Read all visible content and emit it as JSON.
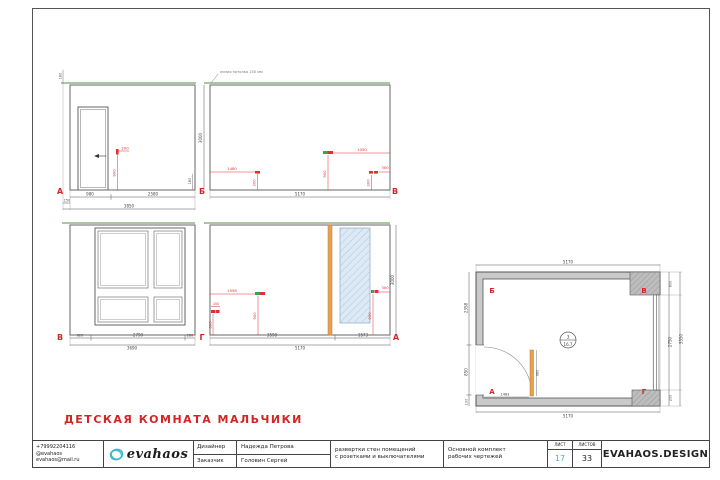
{
  "title": "ДЕТСКАЯ КОМНАТА МАЛЬЧИКИ",
  "colors": {
    "accent_red": "#d42525",
    "annotation_red": "#e03030",
    "brand_teal": "#3fb9c9",
    "ceiling_green": "#a9c7a2",
    "socket_green": "#2fa84f",
    "radiator_orange": "#e8a04d",
    "wall_gray": "#c9c9c9",
    "hatch_blue": "#ddeaf5"
  },
  "views": {
    "ab": {
      "corner_left": "А",
      "corner_right": "Б",
      "dim_ceiling": "180",
      "dim_skirt": "180",
      "switch_offset": "200",
      "switch_height": "900",
      "dim_door": "980",
      "dim_rest": "2580",
      "dim_offset": "150",
      "dim_total": "3850"
    },
    "bv": {
      "corner_right": "В",
      "note": "линия потолка 150 мм",
      "height": "3000",
      "s1_off": "1480",
      "s1_h": "300",
      "s2_off": "1050",
      "s2_h": "900",
      "s3_off": "300",
      "s3_h": "300",
      "dim_total": "5170"
    },
    "vg": {
      "corner_left": "В",
      "corner_right": "Г",
      "d1": "620",
      "d2": "2790",
      "d3": "280",
      "dim_total": "3690"
    },
    "ga": {
      "corner_right": "А",
      "height": "3000",
      "s1_off": "100",
      "s1_h": "300",
      "s2_off": "1558",
      "s2_h": "900",
      "s3_off": "300",
      "s3_h": "900",
      "d1": "3598",
      "d2": "1573",
      "dim_total": "5170"
    }
  },
  "plan": {
    "corner_tl": "Б",
    "corner_tr": "В",
    "corner_bl": "А",
    "corner_br": "Г",
    "dim_top": "5170",
    "dim_bottom": "5170",
    "dim_left_upper": "2358",
    "dim_left_lower": "850",
    "dim_left_small": "100",
    "dim_right_top": "600",
    "dim_right_mid": "2750",
    "dim_right_bottom": "200",
    "dim_right_total": "3550",
    "dim_door": "1483",
    "dim_radiator": "980",
    "stamp_number": "3",
    "stamp_area": "16.7"
  },
  "titleblock": {
    "phone": "+79992204116",
    "social": "@evahaos",
    "email": "evahaos@mail.ru",
    "logo_text": "evahaos",
    "designer_label": "Дизайнер",
    "designer_name": "Надежда Петрова",
    "client_label": "Заказчик",
    "client_name": "Головин Сергей",
    "description_line1": "развертки стен помещений",
    "description_line2": "с розетками и выключателями",
    "set_line1": "Основной комплект",
    "set_line2": "рабочих чертежей",
    "sheet_label": "ЛИСТ",
    "sheet_value": "17",
    "sheets_label": "ЛИСТОВ",
    "sheets_value": "33",
    "brand": "EVAHAOS.DESIGN"
  }
}
